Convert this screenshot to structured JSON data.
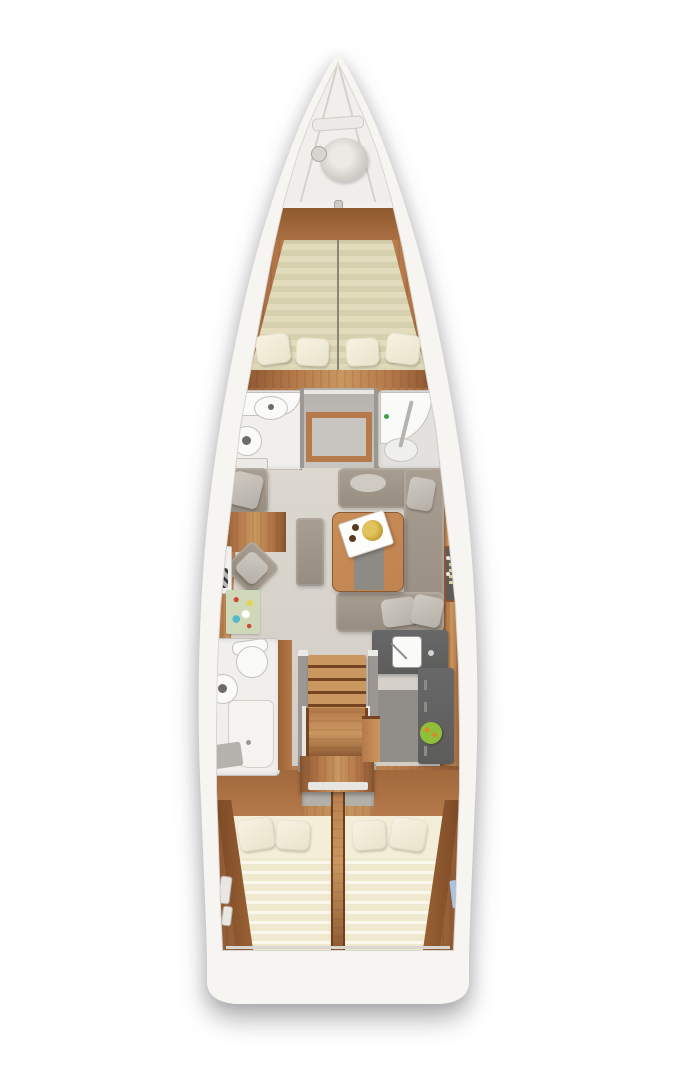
{
  "meta": {
    "description": "Sailing yacht interior floor plan, top-down view, no visible text labels",
    "canvas": {
      "width": 675,
      "height": 1080
    }
  },
  "palette": {
    "hull": "#f6f5f2",
    "seam": "#d9d6d1",
    "bowDeck": "#efeeeb",
    "wood": "#b5794a",
    "woodLight": "#c9975f",
    "woodDark": "#8a5530",
    "woodDeep": "#74431f",
    "floor": "#d8d4cc",
    "floorDark": "#c6c2bb",
    "wall": "#9b9894",
    "wallLight": "#c8c5c0",
    "matA": "#d6d0ae",
    "matB": "#e2dcbc",
    "aftA": "#efe9cf",
    "aftB": "#faf7ec",
    "pillow": "#e9e3cb",
    "pillowAft": "#f3eed8",
    "bath": "#f0efec",
    "bathDim": "#e3e1dd",
    "fixture": "#fafaf8",
    "fixtureRim": "#c5c2bc",
    "sofa": "#968c80",
    "sofaLight": "#a89e92",
    "cushion": "#b5afa7",
    "cushionLight": "#cfcac2",
    "counter": "#5c5c5a",
    "tableWood": "#bf8351",
    "tray": "#fdfdfc",
    "gold": "#c79f33",
    "goldDark": "#8f6d1c",
    "rugBase": "#cfd8b8",
    "rugTeal": "#4fb8c9",
    "rugRed": "#cf4a36",
    "rugYellow": "#e6d356",
    "fruitGreen": "#8fbf3a",
    "fruitOrange": "#e0862e",
    "blueTowel": "#aac3de",
    "accentGreen": "#3f9e4f",
    "ink": "#2e2e30"
  },
  "scene": {
    "vessel": "monohull-sailing-yacht-deck-plan",
    "rooms": [
      "bow-anchor-locker",
      "forward-vberth-cabin",
      "port-forward-head",
      "starboard-forward-head",
      "midship-passage",
      "salon",
      "nav-station",
      "galley",
      "port-aft-head",
      "companionway-stairs",
      "port-aft-double-cabin",
      "starboard-aft-double-cabin",
      "stern-transom"
    ],
    "furniture": [
      "anchor-rope-coil",
      "windlass-bar",
      "vberth-double-mattress",
      "vberth-pillows",
      "toilet",
      "washbasin",
      "shower-enclosure",
      "wardrobe-opening",
      "u-shaped-sofa",
      "coffee-table",
      "serving-tray",
      "gold-plate",
      "ottoman-bench",
      "armchair",
      "rotated-armchair",
      "chart-table",
      "laptop",
      "slatted-bench",
      "area-rug",
      "bar-shelf-with-bottles",
      "galley-sink",
      "galley-counter",
      "fruit-bowl",
      "stair-treads",
      "aft-double-berths",
      "aft-pillows",
      "blue-towel",
      "white-grab-handles"
    ]
  }
}
